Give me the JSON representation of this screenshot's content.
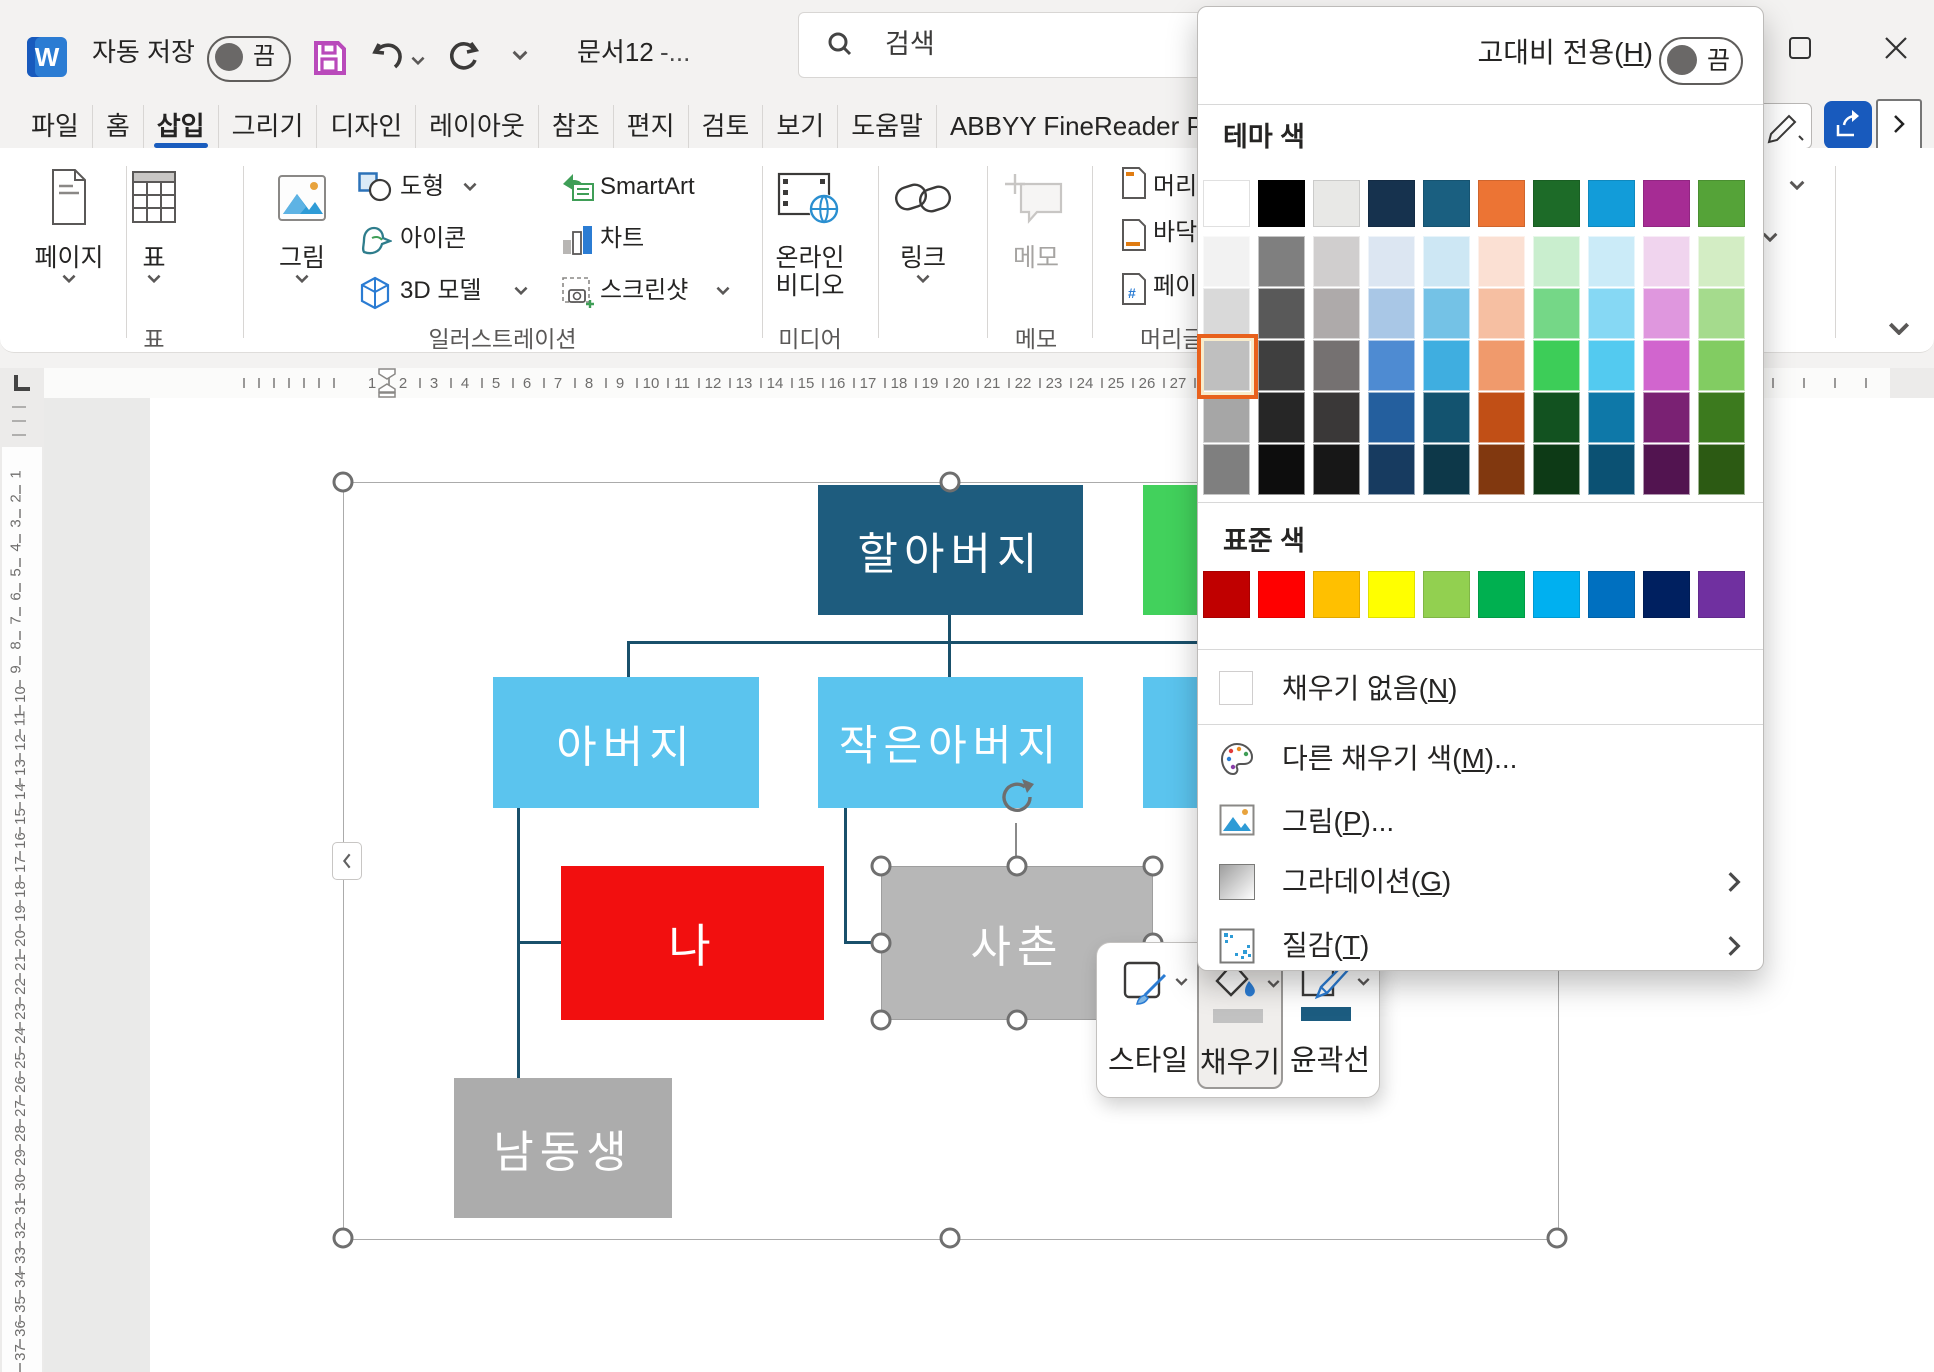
{
  "titlebar": {
    "autosave_label": "자동 저장",
    "autosave_state": "끔",
    "doc_title": "문서12",
    "doc_title_suffix": "-...",
    "search_placeholder": "검색"
  },
  "tabs": [
    {
      "label": "파일"
    },
    {
      "label": "홈"
    },
    {
      "label": "삽입",
      "active": true
    },
    {
      "label": "그리기"
    },
    {
      "label": "디자인"
    },
    {
      "label": "레이아웃"
    },
    {
      "label": "참조"
    },
    {
      "label": "편지"
    },
    {
      "label": "검토"
    },
    {
      "label": "보기"
    },
    {
      "label": "도움말"
    },
    {
      "label": "ABBYY FineReader PDF"
    }
  ],
  "ribbon": {
    "pages": "페이지",
    "table": "표",
    "picture": "그림",
    "shapes": "도형",
    "icons": "아이콘",
    "model3d": "3D 모델",
    "smartart": "SmartArt",
    "chart": "차트",
    "screenshot": "스크린샷",
    "video_line1": "온라인",
    "video_line2": "비디오",
    "link": "링크",
    "memo": "메모",
    "header": "머리글",
    "footer": "바닥글",
    "pagenum": "페이지 번호",
    "group_table": "표",
    "group_illustration": "일러스트레이션",
    "group_media": "미디어",
    "group_memo": "메모",
    "group_header": "머리글/바닥글"
  },
  "ruler": {
    "h_numbers": [
      1,
      2,
      3,
      4,
      5,
      6,
      7,
      8,
      9,
      10,
      11,
      12,
      13,
      14,
      15,
      16,
      17,
      18,
      19,
      20,
      21,
      22,
      23,
      24,
      25,
      26,
      27
    ],
    "v_numbers": [
      1,
      2,
      3,
      4,
      5,
      6,
      7,
      8,
      9,
      10,
      11,
      12,
      13,
      14,
      15,
      16,
      17,
      18,
      19,
      20,
      21,
      22,
      23,
      24,
      25,
      26,
      27,
      28,
      29,
      30,
      31,
      32,
      33,
      34,
      35,
      36,
      37
    ]
  },
  "diagram": {
    "boxes": [
      {
        "label": "할아버지",
        "color": "#1E5C7E",
        "x": 818,
        "y": 485,
        "w": 265,
        "h": 130,
        "font": 44
      },
      {
        "label": "",
        "color": "#42D15C",
        "x": 1143,
        "y": 485,
        "w": 68,
        "h": 130,
        "font": 44
      },
      {
        "label": "아버지",
        "color": "#5BC4EE",
        "x": 493,
        "y": 677,
        "w": 266,
        "h": 131,
        "font": 44
      },
      {
        "label": "작은아버지",
        "color": "#5BC4EE",
        "x": 818,
        "y": 677,
        "w": 265,
        "h": 131,
        "font": 42
      },
      {
        "label": "",
        "color": "#5BC4EE",
        "x": 1143,
        "y": 677,
        "w": 68,
        "h": 131,
        "font": 44
      },
      {
        "label": "나",
        "color": "#F20F0F",
        "x": 561,
        "y": 866,
        "w": 263,
        "h": 154,
        "font": 46
      },
      {
        "label": "사촌",
        "color": "#B7B7B7",
        "x": 881,
        "y": 866,
        "w": 272,
        "h": 154,
        "font": 44,
        "selected": true
      },
      {
        "label": "남동생",
        "color": "#ACACAC",
        "x": 454,
        "y": 1078,
        "w": 218,
        "h": 140,
        "font": 44
      }
    ],
    "connector_color": "#19506B"
  },
  "mini_toolbar": {
    "style_label": "스타일",
    "fill_label": "채우기",
    "outline_label": "윤곽선",
    "fill_bar": "#C2C2C2",
    "outline_bar": "#1C5C80"
  },
  "dropdown": {
    "contrast_pre": "고대비 전용(",
    "contrast_key": "H",
    "contrast_suf": ")",
    "contrast_state": "끔",
    "theme_label": "테마 색",
    "standard_label": "표준 색",
    "theme_colors": [
      "#FFFFFF",
      "#000000",
      "#E8E8E6",
      "#16324E",
      "#1A5F80",
      "#EC7434",
      "#1D6B28",
      "#129CD9",
      "#A62C94",
      "#55A338"
    ],
    "theme_variants": [
      "#F2F2F2",
      "#7F7F7F",
      "#D0CECE",
      "#DCE6F2",
      "#CDE7F4",
      "#FBE0D3",
      "#C9EECE",
      "#CBEBF8",
      "#F0D4EE",
      "#D3EDC4",
      "#D9D9D9",
      "#595959",
      "#AEAAAA",
      "#A9C7E6",
      "#74C2E6",
      "#F6BFA2",
      "#75D787",
      "#86D8F4",
      "#DF97DE",
      "#A5DB8D",
      "#BFBFBF",
      "#3F3F3F",
      "#757171",
      "#4E8BD2",
      "#3FAEE0",
      "#F09A6C",
      "#3DCD58",
      "#53CAF0",
      "#D165CE",
      "#82CC62",
      "#A6A6A6",
      "#262626",
      "#3A3838",
      "#245F9E",
      "#13536F",
      "#C14F16",
      "#125220",
      "#0E78A8",
      "#7A2173",
      "#3C7A1E",
      "#7F7F7F",
      "#0D0D0D",
      "#171717",
      "#173B60",
      "#0D3849",
      "#81380F",
      "#0D3A16",
      "#0B5173",
      "#521450",
      "#2C5A13"
    ],
    "selected_variant": {
      "row": 3,
      "col": 1
    },
    "standard_colors": [
      "#C00000",
      "#FF0000",
      "#FFC000",
      "#FFFF00",
      "#92D050",
      "#00B050",
      "#00B0F0",
      "#0070C0",
      "#002060",
      "#7030A0"
    ],
    "items": [
      {
        "pre": "채우기 없음(",
        "key": "N",
        "suf": ")"
      },
      {
        "pre": "다른 채우기 색(",
        "key": "M",
        "suf": ")..."
      },
      {
        "pre": "그림(",
        "key": "P",
        "suf": ")..."
      },
      {
        "pre": "그라데이션(",
        "key": "G",
        "suf": ")",
        "submenu": true
      },
      {
        "pre": "질감(",
        "key": "T",
        "suf": ")",
        "submenu": true
      }
    ]
  }
}
